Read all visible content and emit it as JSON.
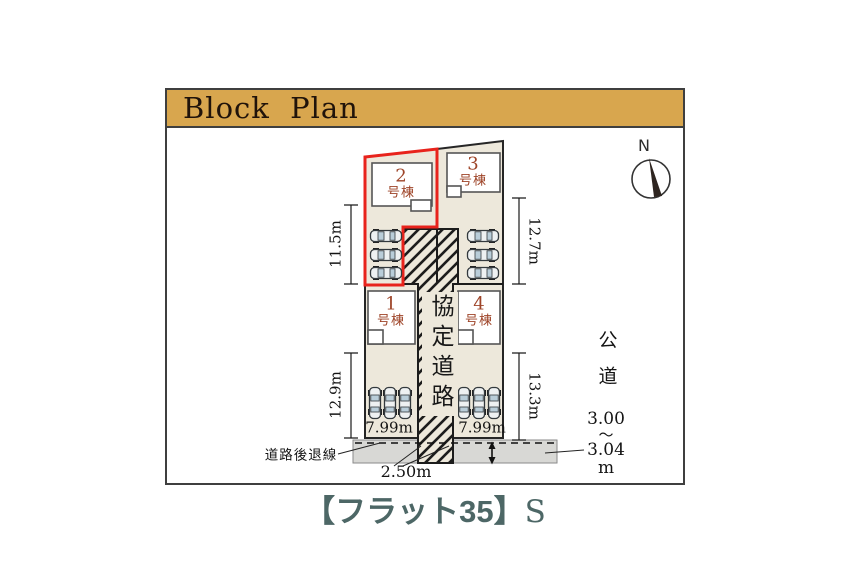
{
  "colors": {
    "header_gold": "#D8A64E",
    "highlight_red": "#E8231C",
    "lot_beige": "#EDE8DB",
    "road_gray": "#D8D8D5",
    "building_label_brown": "#9E4428",
    "caption_teal": "#4D6766"
  },
  "header": {
    "title": "Block Plan"
  },
  "compass": {
    "north_label": "N"
  },
  "plan": {
    "buildings": [
      {
        "num": "2",
        "sub": "号棟",
        "highlighted": true
      },
      {
        "num": "3",
        "sub": "号棟",
        "highlighted": false
      },
      {
        "num": "1",
        "sub": "号棟",
        "highlighted": false
      },
      {
        "num": "4",
        "sub": "号棟",
        "highlighted": false
      }
    ],
    "agreement_road_label": "協定道路",
    "setback_line_label": "道路後退線",
    "public_road": {
      "label": "公道",
      "width_from": "3.00",
      "tilde": "〜",
      "width_to": "3.04",
      "unit": "m"
    },
    "dimensions": {
      "lot2_depth": "11.5m",
      "lot3_depth": "12.7m",
      "lot1_depth": "12.9m",
      "lot4_depth": "13.3m",
      "lot1_frontage": "7.99m",
      "lot4_frontage": "7.99m",
      "setback_road_width": "2.50m"
    }
  },
  "caption": {
    "main": "【フラット35】",
    "suffix": "S"
  }
}
